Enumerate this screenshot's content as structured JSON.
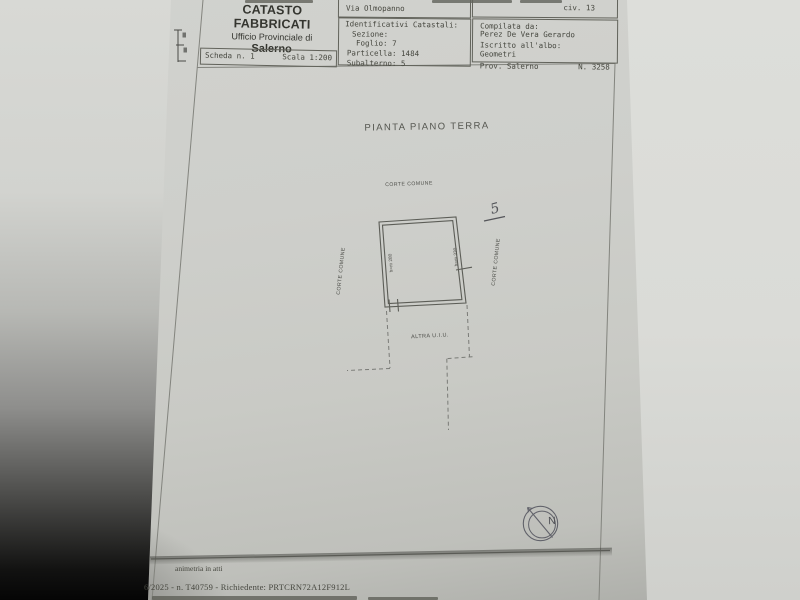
{
  "masthead": {
    "title": "CATASTO FABBRICATI",
    "subtitle": "Ufficio Provinciale di",
    "city": "Salerno"
  },
  "scheda_box": {
    "scheda": "Scheda n. 1",
    "scala": "Scala 1:200"
  },
  "address_box": {
    "street": "Via Olmopanno",
    "civic": "civ. 13"
  },
  "catastali_box": {
    "title": "Identificativi Catastali:",
    "sezione": "Sezione:",
    "foglio": "Foglio: 7",
    "particella": "Particella: 1484",
    "subalterno": "Subalterno: 5"
  },
  "compilata_box": {
    "label": "Compilata da:",
    "name": "Perez De Vera Gerardo",
    "albo_label": "Iscritto all'albo:",
    "albo": "Geometri",
    "prov": "Prov. Salerno",
    "num": "N. 3258"
  },
  "plan": {
    "title": "PIANTA PIANO TERRA",
    "corte_top": "CORTE COMUNE",
    "corte_left": "CORTE COMUNE",
    "corte_right": "CORTE COMUNE",
    "room_height_left": "h=m 280",
    "room_height_right": "h=m 330",
    "altra": "ALTRA U.I.U.",
    "handwritten_mark": "5",
    "compass_north": "N"
  },
  "footer": {
    "line1": "animetria in atti",
    "line2": "6/2025 - n. T40759 - Richiedente: PRTCRN72A12F912L"
  },
  "colors": {
    "background": "#dcddd9",
    "paper": "#cdcec9",
    "ink": "#45463e",
    "print_line": "#6b6c66",
    "pencil": "#54555a"
  }
}
